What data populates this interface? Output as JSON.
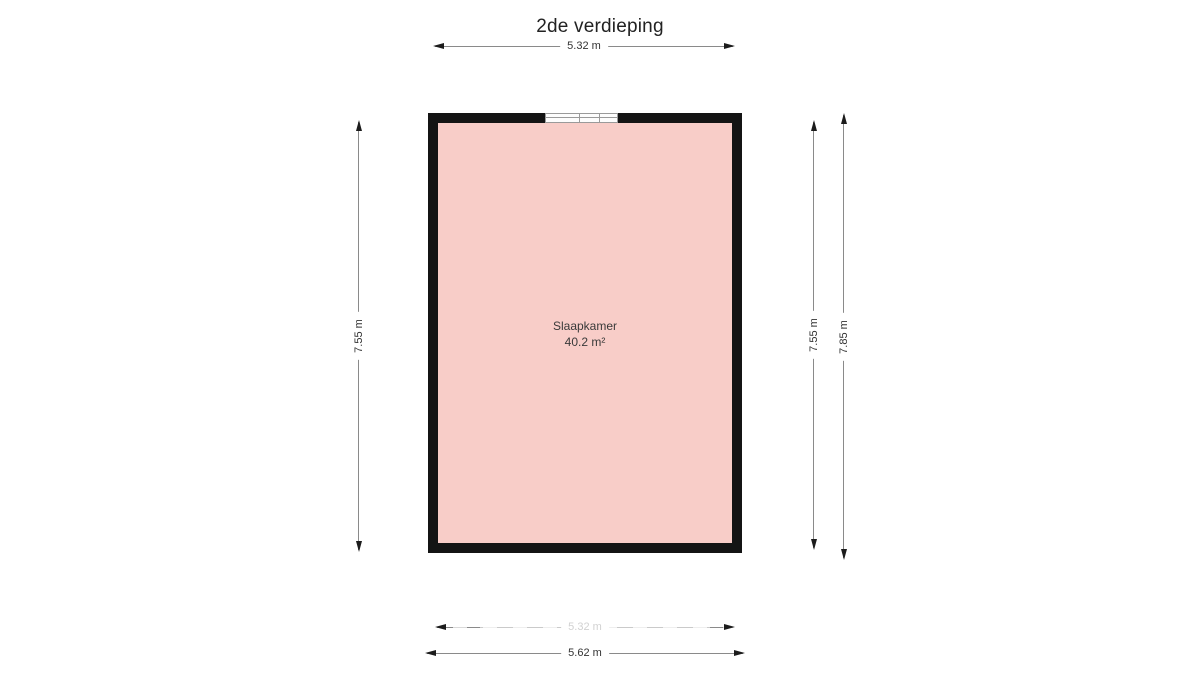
{
  "title": "2de verdieping",
  "room": {
    "name": "Slaapkamer",
    "area": "40.2 m²"
  },
  "dimensions": {
    "top": "5.32 m",
    "left": "7.55 m",
    "right_inner": "7.55 m",
    "right_outer": "7.85 m",
    "bottom_inner": "5.32 m",
    "bottom_outer": "5.62 m"
  },
  "colors": {
    "room_fill": "#f8cdc8",
    "wall": "#141414",
    "dimension_line": "#8a8a8a",
    "text": "#333333"
  }
}
